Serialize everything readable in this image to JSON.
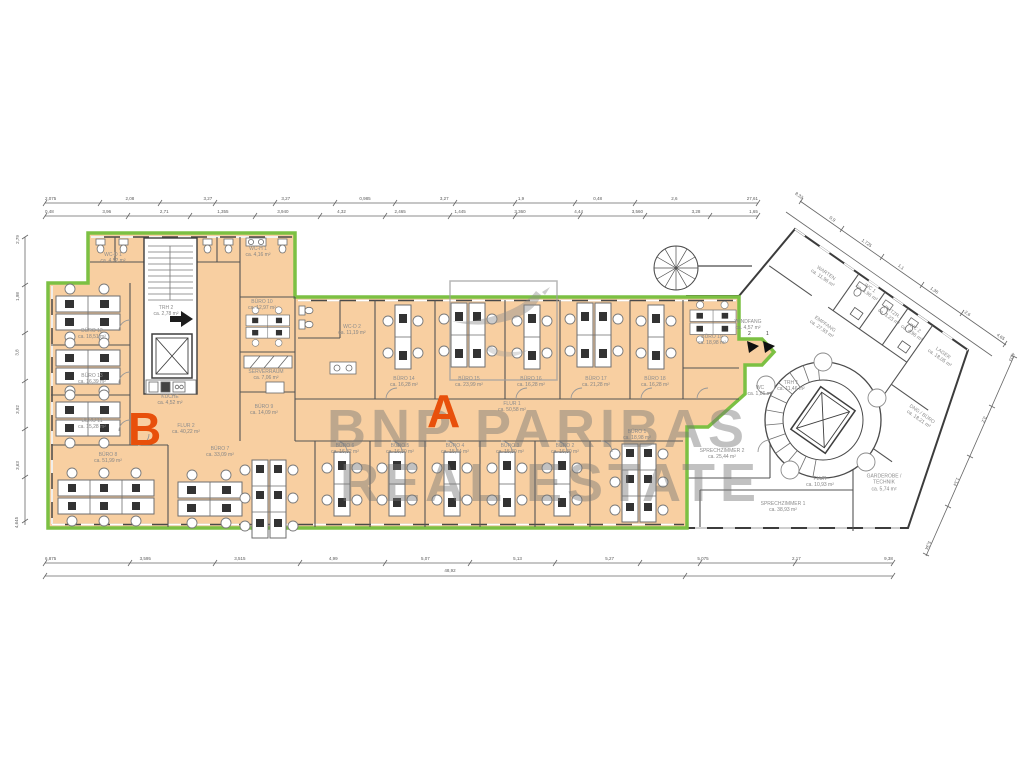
{
  "watermark": {
    "line1": "BNP PARIBAS",
    "line2": "REAL ESTATE"
  },
  "zones": {
    "a": "A",
    "b": "B"
  },
  "entrance": {
    "m1": "2",
    "m2": "1"
  },
  "rooms": [
    {
      "name": "WC-D 1",
      "area": "ca. 4,52 m²"
    },
    {
      "name": "WC-H 1",
      "area": "ca. 4,16 m²"
    },
    {
      "name": "BÜRO 10",
      "area": "ca. 12,97 m²"
    },
    {
      "name": "TRH 2",
      "area": "ca. 2,78 m²"
    },
    {
      "name": "KÜCHE",
      "area": "ca. 4,52 m²"
    },
    {
      "name": "BÜRO 12",
      "area": "ca. 18,51 m²"
    },
    {
      "name": "BÜRO 13",
      "area": "ca. 16,39 m²"
    },
    {
      "name": "BÜRO 11",
      "area": "ca. 15,28 m²"
    },
    {
      "name": "BÜRO 8",
      "area": "ca. 51,99 m²"
    },
    {
      "name": "BÜRO 7",
      "area": "ca. 33,09 m²"
    },
    {
      "name": "SERVERRAUM",
      "area": "ca. 7,06 m²"
    },
    {
      "name": "BÜRO 9",
      "area": "ca. 14,09 m²"
    },
    {
      "name": "FLUR 2",
      "area": "ca. 40,22 m²"
    },
    {
      "name": "WC-D 2",
      "area": "ca. 11,19 m²"
    },
    {
      "name": "BÜRO 14",
      "area": "ca. 16,28 m²"
    },
    {
      "name": "BÜRO 15",
      "area": "ca. 23,99 m²"
    },
    {
      "name": "BÜRO 16",
      "area": "ca. 16,28 m²"
    },
    {
      "name": "BÜRO 17",
      "area": "ca. 21,28 m²"
    },
    {
      "name": "BÜRO 18",
      "area": "ca. 16,28 m²"
    },
    {
      "name": "BÜRO 19",
      "area": "ca. 18,98 m²"
    },
    {
      "name": "FLUR 1",
      "area": "ca. 50,58 m²"
    },
    {
      "name": "BÜRO 6",
      "area": "ca. 16,32 m²"
    },
    {
      "name": "BÜRO 5",
      "area": "ca. 16,30 m²"
    },
    {
      "name": "BÜRO 4",
      "area": "ca. 15,44 m²"
    },
    {
      "name": "BÜRO 3",
      "area": "ca. 15,80 m²"
    },
    {
      "name": "BÜRO 2",
      "area": "ca. 16,80 m²"
    },
    {
      "name": "BÜRO 1",
      "area": "ca. 18,98 m²"
    },
    {
      "name": "WINDFANG",
      "area": "ca. 4,57 m²"
    },
    {
      "name": "WC",
      "area": "ca. 1,86 m²"
    },
    {
      "name": "TRH 1",
      "area": "ca. 11,46 m²"
    },
    {
      "name": "EMPFANG",
      "area": "ca. 27,93 m²"
    },
    {
      "name": "WARTEN",
      "area": "ca. 11,96 m²"
    },
    {
      "name": "WC 1",
      "area": "ca. 4,96 m²"
    },
    {
      "name": "PUTZR.",
      "area": "ca. 3,23 m²"
    },
    {
      "name": "WC 2",
      "area": "ca. 4,96 m²"
    },
    {
      "name": "LAGER",
      "area": "ca. 18,05 m²"
    },
    {
      "name": "DNG / BÜRO",
      "area": "ca. 18,21 m²"
    },
    {
      "name": "SPRECHZIMMER 2",
      "area": "ca. 25,44 m²"
    },
    {
      "name": "SPRECHZIMMER 1",
      "area": "ca. 38,93 m²"
    },
    {
      "name": "FLUR",
      "area": "ca. 10,93 m²"
    },
    {
      "name": "GARDEROBE / TECHNIK",
      "area": "ca. 5,74 m²"
    }
  ],
  "dims": {
    "top1": [
      "2,075",
      "2,08",
      "3,27",
      "3,27",
      "0,985",
      "3,27",
      "1,9",
      "0,48",
      "2,6",
      "27,61"
    ],
    "top2": [
      "0,48",
      "3,96",
      "2,71",
      "1,355",
      "3,940",
      "4,32",
      "2,465",
      "1,445",
      "3,360",
      "4,44",
      "3,560",
      "3,28",
      "1,65"
    ],
    "bottom1": [
      "6,875",
      "3,595",
      "3,515",
      "4,99",
      "5,07",
      "5,13",
      "5,27",
      "5,075",
      "2,17",
      "9,38"
    ],
    "total": "48,92",
    "left": [
      "2,79",
      "1,98",
      "3,8",
      "3,92",
      "3,63",
      "4,645"
    ],
    "top_right": [
      "8,32",
      "0,9",
      "1,725",
      "1,1",
      "1,36",
      "2,6",
      "4,65"
    ],
    "right": [
      "4,03",
      "3,2",
      "1,14",
      "5,34"
    ]
  },
  "colors": {
    "highlight_fill": "#f8cfa1",
    "highlight_outline": "#7cc043",
    "zone_letter": "#e8500b",
    "walls": "#3c3c3c",
    "watermark": "#767676"
  }
}
